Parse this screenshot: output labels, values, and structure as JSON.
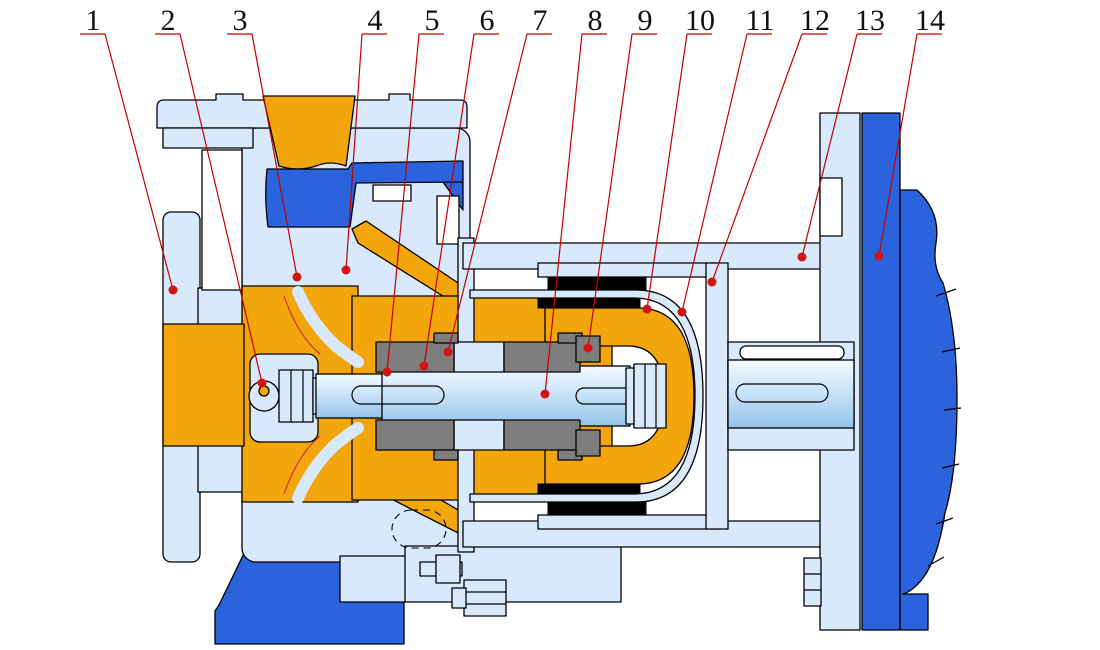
{
  "figure": {
    "kind": "pump-cross-section-technical-drawing",
    "width": 1100,
    "height": 650,
    "background": "#ffffff"
  },
  "palette": {
    "casing_light": "#d7e9fb",
    "fluid_orange": "#f3a50c",
    "accent_dark_blue": "#2b63dd",
    "bearing_gray": "#7e7e7e",
    "magnet_black": "#000000",
    "outline_black": "#000000",
    "leader_line_red": "#c40000",
    "leader_dot_red": "#d21414",
    "shaft_highlight": "#f2f9ff",
    "shaft_shadow": "#96c2e9"
  },
  "callouts": {
    "font_size": 30,
    "number_baseline_y": 30,
    "underline_y": 34,
    "labels": [
      {
        "n": "1",
        "x": 93,
        "tx": 173,
        "ty": 290
      },
      {
        "n": "2",
        "x": 168,
        "tx": 262,
        "ty": 383
      },
      {
        "n": "3",
        "x": 240,
        "tx": 297,
        "ty": 277
      },
      {
        "n": "4",
        "x": 375,
        "tx": 346,
        "ty": 270
      },
      {
        "n": "5",
        "x": 432,
        "tx": 387,
        "ty": 372
      },
      {
        "n": "6",
        "x": 487,
        "tx": 424,
        "ty": 366
      },
      {
        "n": "7",
        "x": 540,
        "tx": 448,
        "ty": 352
      },
      {
        "n": "8",
        "x": 595,
        "tx": 545,
        "ty": 394
      },
      {
        "n": "9",
        "x": 645,
        "tx": 588,
        "ty": 348
      },
      {
        "n": "10",
        "x": 700,
        "tx": 647,
        "ty": 309
      },
      {
        "n": "11",
        "x": 760,
        "tx": 682,
        "ty": 312
      },
      {
        "n": "12",
        "x": 815,
        "tx": 712,
        "ty": 282
      },
      {
        "n": "13",
        "x": 870,
        "tx": 802,
        "ty": 257
      },
      {
        "n": "14",
        "x": 930,
        "tx": 879,
        "ty": 256
      }
    ]
  }
}
